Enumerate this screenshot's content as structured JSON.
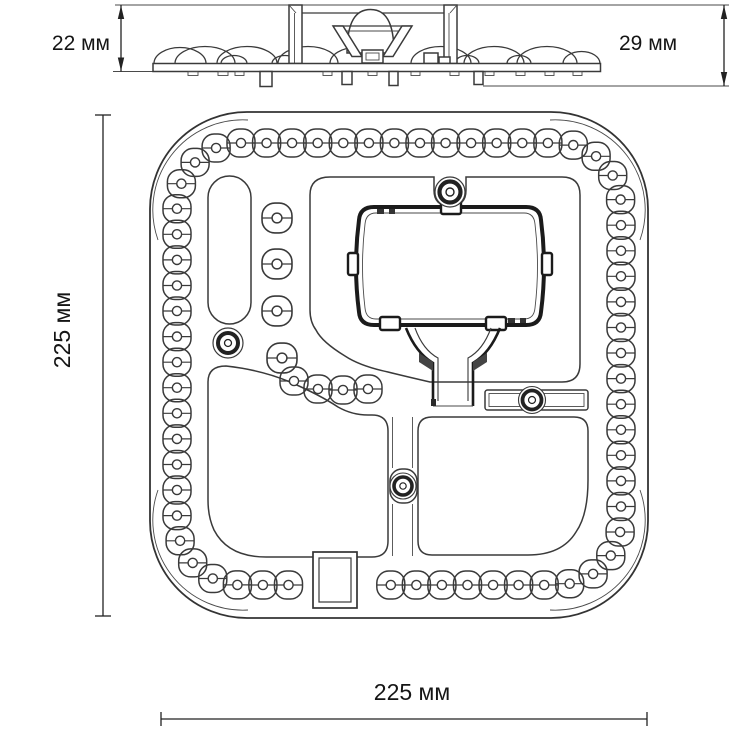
{
  "drawing": {
    "dimensions": {
      "side_height": "22 мм",
      "side_total_height": "29 мм",
      "plan_height": "225 мм",
      "plan_width": "225 мм"
    },
    "line_color": "#3a3a3a",
    "accent_color": "#1b1b1b"
  }
}
